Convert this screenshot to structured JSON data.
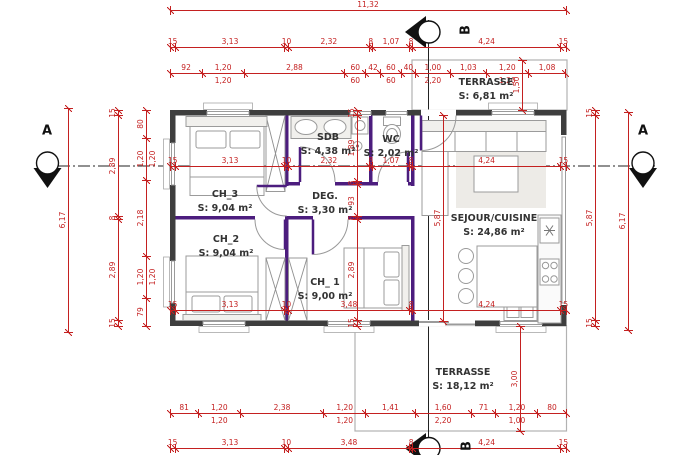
{
  "plan": {
    "rooms": {
      "ch3": {
        "name": "CH_3",
        "area": "S: 9,04 m²"
      },
      "ch2": {
        "name": "CH_2",
        "area": "S: 9,04 m²"
      },
      "ch1": {
        "name": "CH_ 1",
        "area": "S: 9,00 m²"
      },
      "sdb": {
        "name": "SDB",
        "area": "S: 4,38 m²"
      },
      "wc": {
        "name": "WC",
        "area": "S: 2,02 m²"
      },
      "deg": {
        "name": "DEG.",
        "area": "S: 3,30 m²"
      },
      "sejour": {
        "name": "SEJOUR/CUISINE",
        "area": "S: 24,86 m²"
      },
      "terrasse_top": {
        "name": "TERRASSE",
        "area": "S: 6,81 m²"
      },
      "terrasse_bottom": {
        "name": "TERRASSE",
        "area": "S: 18,12 m²"
      }
    },
    "sections": {
      "left": "A",
      "right": "A",
      "top": "B",
      "bottom": "B"
    },
    "colors": {
      "dimension": "#c42020",
      "wall": "#3e3e3e",
      "partition": "#4c1d7e"
    },
    "chains": {
      "top_total": [
        "11,32"
      ],
      "top_axes": [
        "15",
        "3,13",
        "10",
        "2,32",
        "8",
        "1,07",
        "8",
        "4,24",
        "15"
      ],
      "top_openings": [
        "92",
        "1,20|1,20",
        "2,88",
        "60|60",
        "42",
        "60|60",
        "40",
        "1,00|2,20",
        "1,03",
        "1,20|1,20",
        "1,08"
      ],
      "mid_axes": [
        "15",
        "3,13",
        "10",
        "2,32",
        "8",
        "1,07",
        "8",
        "4,24",
        "15"
      ],
      "lower_axes": [
        "15",
        "3,13",
        "10",
        "3,48",
        "8",
        "4,24",
        "15"
      ],
      "bottom_openings": [
        "81",
        "1,20|1,20",
        "2,38",
        "1,20|1,20",
        "1,41",
        "1,60|2,20",
        "71",
        "1,20|1,00",
        "80"
      ],
      "bottom_axes": [
        "15",
        "3,13",
        "10",
        "3,48",
        "8",
        "4,24",
        "15"
      ],
      "left_total": [
        "6,17"
      ],
      "left_axes": [
        "15",
        "2,89",
        "8",
        "2,89",
        "15"
      ],
      "left_openings": [
        "80",
        "1,20|1,20",
        "2,18",
        "1,20|1,20",
        "79"
      ],
      "middle_vertical": [
        "15",
        "1,89",
        "8",
        "93",
        "8",
        "2,89",
        "15"
      ],
      "sejour_height": [
        "5,87"
      ],
      "right_axes": [
        "15",
        "5,87",
        "15"
      ],
      "right_total": [
        "6,17"
      ],
      "terrasse_top_depth": [
        "1,50"
      ],
      "terrasse_bottom_depth": [
        "3,00"
      ]
    }
  }
}
